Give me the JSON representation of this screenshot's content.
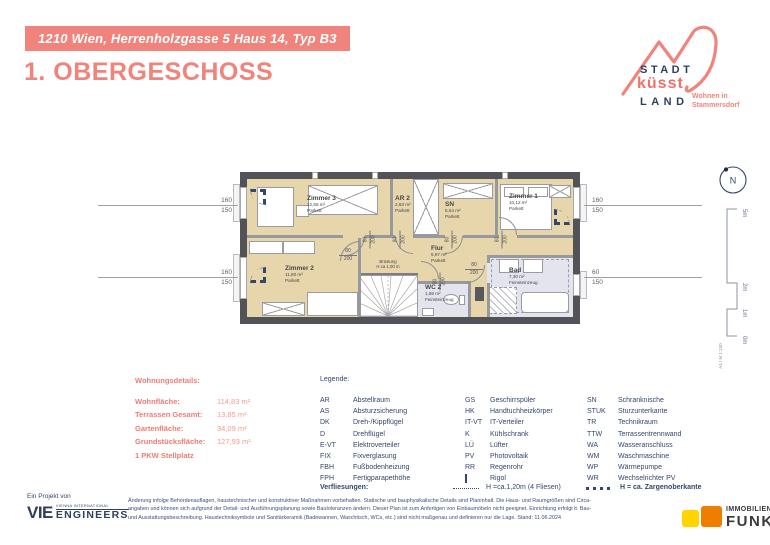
{
  "header": {
    "banner": "1210 Wien, Herrenholzgasse 5 Haus 14, Typ B3",
    "title": "1. OBERGESCHOSS"
  },
  "logo": {
    "stadt": "STADT",
    "kuesst": "küsst",
    "land": "LAND",
    "tagline1": "Wohnen in",
    "tagline2": "Stammersdorf"
  },
  "plan": {
    "rooms": [
      {
        "name": "Zimmer 3",
        "area": "12,55 m²",
        "floor": "Parkett"
      },
      {
        "name": "AR 2",
        "area": "2,83 m²",
        "floor": "Parkett"
      },
      {
        "name": "SN",
        "area": "5,54 m²",
        "floor": "Parkett"
      },
      {
        "name": "Zimmer 1",
        "area": "10,12 m²",
        "floor": "Parkett"
      },
      {
        "name": "Zimmer 2",
        "area": "11,80 m²",
        "floor": "Parkett"
      },
      {
        "name": "Flur",
        "area": "5,97 m²",
        "floor": "Parkett"
      },
      {
        "name": "WC 2",
        "area": "1,88 m²",
        "floor": "Feinsteinzeug"
      },
      {
        "name": "Bad",
        "area": "7,30 m²",
        "floor": "Feinsteinzeug"
      }
    ],
    "door": {
      "w": "80",
      "h": "200"
    },
    "stair_note": {
      "l1": "Brüstung",
      "l2": "H ca 1,00 m"
    },
    "dims": {
      "lt": {
        "a": "160",
        "b": "150"
      },
      "lb": {
        "a": "160",
        "b": "150"
      },
      "rt": {
        "a": "160",
        "b": "150"
      },
      "rb": {
        "a": "60",
        "b": "150"
      }
    },
    "compass": "N",
    "scale": {
      "m5": "5m",
      "m2": "2m",
      "m1": "1m",
      "m0": "0m",
      "sheet": "A4 / M 1:100"
    }
  },
  "details": {
    "title": "Wohnungsdetails:",
    "rows": [
      {
        "label": "Wohnfläche:",
        "value": "114,83 m²"
      },
      {
        "label": "Terrassen Gesamt:",
        "value": "13,85 m²"
      },
      {
        "label": "Gartenfläche:",
        "value": "34,09 m²"
      },
      {
        "label": "Grundstücksfläche:",
        "value": "127,93 m²"
      }
    ],
    "note": "1 PKW Stellplatz"
  },
  "legend": {
    "title": "Legende:",
    "col1": [
      {
        "abbr": "AR",
        "term": "Abstellraum"
      },
      {
        "abbr": "AS",
        "term": "Absturzsicherung"
      },
      {
        "abbr": "DK",
        "term": "Dreh-/Kippflügel"
      },
      {
        "abbr": "D",
        "term": "Drehflügel"
      },
      {
        "abbr": "E-VT",
        "term": "Elektroverteiler"
      },
      {
        "abbr": "FIX",
        "term": "Fixverglasung"
      },
      {
        "abbr": "FBH",
        "term": "Fußbodenheizung"
      },
      {
        "abbr": "FPH",
        "term": "Fertigparapethöhe"
      }
    ],
    "col2": [
      {
        "abbr": "GS",
        "term": "Geschirrspüler"
      },
      {
        "abbr": "HK",
        "term": "Handtuchheizkörper"
      },
      {
        "abbr": "IT-VT",
        "term": "IT-Verteiler"
      },
      {
        "abbr": "K",
        "term": "Kühlschrank"
      },
      {
        "abbr": "LÜ",
        "term": "Lüfter"
      },
      {
        "abbr": "PV",
        "term": "Photovoltaik"
      },
      {
        "abbr": "RR",
        "term": "Regenrohr"
      },
      {
        "abbr": "",
        "term": "Rigol",
        "icon": "rigol-icon"
      }
    ],
    "col3": [
      {
        "abbr": "SN",
        "term": "Schranknische"
      },
      {
        "abbr": "STUK",
        "term": "Sturzunterkante"
      },
      {
        "abbr": "TR",
        "term": "Technikraum"
      },
      {
        "abbr": "TTW",
        "term": "Terrassentrennwand"
      },
      {
        "abbr": "WA",
        "term": "Wasseranschluss"
      },
      {
        "abbr": "WM",
        "term": "Waschmaschine"
      },
      {
        "abbr": "WP",
        "term": "Wärmepumpe"
      },
      {
        "abbr": "WR",
        "term": "Wechselrichter PV"
      }
    ],
    "verfliesungen": {
      "label": "Verfliesungen:",
      "item1": "H =ca.1,20m  (4 Fliesen)",
      "item2": "H = ca. Zargenoberkante"
    }
  },
  "footer": {
    "project_label": "Ein Projekt von",
    "vie": {
      "abbr": "VIE",
      "line1": "VIENNA INTERNATIONAL",
      "line2": "ENGINEERS"
    },
    "disclaimer_lines": [
      "Änderung infolge Behördenauflagen, haustechnischer und konstruktiver Maßnahmen vorbehalten. Statische und bauphysikalische Details sind Planinhalt. Die Haus- und Raumgrößen sind Circa-",
      "angaben und können sich aufgrund der Detail- und Ausführungsplanung sowie Bautoleranzen ändern. Dieser Plan ist zum Anfertigen von Einbaumöbeln nicht geeignet. Einrichtung erfolgt lt. Bau-",
      "und Ausstattungsbeschreibung. Haustechniksymbole und Sanitärkeramik (Badewannen, Waschtisch, WCs, etc.) sind nicht maßgenau und definieren nur die Lage.  Stand: 11.06.2024"
    ],
    "funk": {
      "line1": "IMMOBILIEN",
      "line2": "FUNK"
    }
  },
  "colors": {
    "accent": "#f0837c",
    "navy": "#35466b",
    "parquet": "#e7d6ab",
    "tile": "#e4e4ee",
    "funk_yellow": "#ffd400",
    "funk_orange": "#ef7d00"
  }
}
